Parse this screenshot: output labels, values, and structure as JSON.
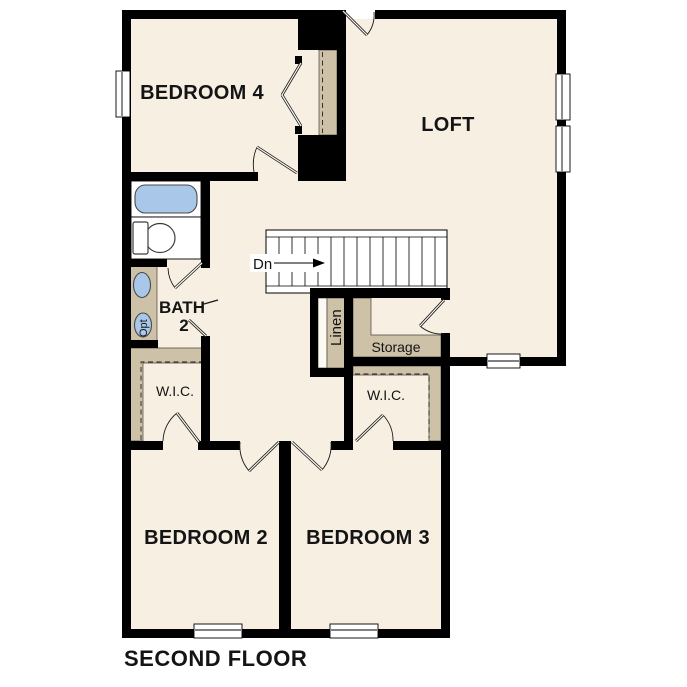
{
  "page_title": "SECOND FLOOR",
  "rooms": {
    "bedroom4": {
      "label": "BEDROOM 4"
    },
    "loft": {
      "label": "LOFT"
    },
    "bath": {
      "label_line1": "BATH",
      "label_line2": "2"
    },
    "bedroom2": {
      "label": "BEDROOM 2"
    },
    "bedroom3": {
      "label": "BEDROOM 3"
    },
    "wic_left": {
      "label": "W.I.C."
    },
    "wic_right": {
      "label": "W.I.C."
    },
    "linen": {
      "label": "Linen"
    },
    "storage": {
      "label": "Storage"
    }
  },
  "stairs": {
    "direction_label": "Dn"
  },
  "fixtures": {
    "optional_sink_label": "Opt"
  },
  "colors": {
    "background": "#ffffff",
    "floor": "#f6efe2",
    "wall": "#000000",
    "cabinet_tan": "#cdc1a8",
    "fixture_blue": "#a9c8e9"
  }
}
